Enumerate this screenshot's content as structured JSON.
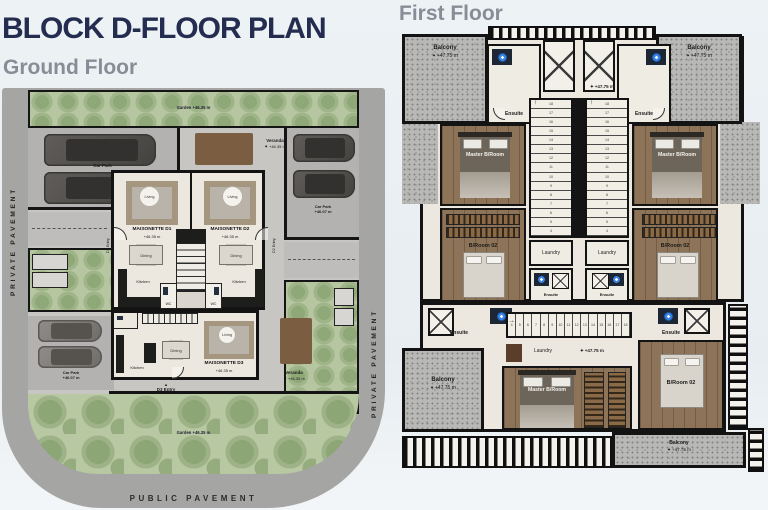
{
  "header": {
    "title": "BLOCK D-FLOOR PLAN",
    "ground_floor_label": "Ground Floor",
    "first_floor_label": "First Floor"
  },
  "icons": {
    "compass": "✦",
    "stair_arrow": "↑",
    "entry_marker": "▲"
  },
  "colors": {
    "title_navy": "#242d4f",
    "subtitle_gray": "#878d96",
    "pavement_gray": "#a5a5a3",
    "courtyard_gray": "#c8c6c3",
    "garden_green": "#b6c6a0",
    "wall_black": "#141414",
    "floor_beige": "#ece8df",
    "wood_brown": "#8d7358",
    "fixture_blue": "#3b87e8"
  },
  "ground_floor": {
    "pavement": {
      "private_label": "PRIVATE PAVEMENT",
      "public_label": "PUBLIC PAVEMENT"
    },
    "garden": {
      "label": "Garden",
      "level": "+46.35 m"
    },
    "car_park": {
      "label": "Car Park",
      "level": "+46.07 m"
    },
    "veranda": {
      "label": "Veranda",
      "level": "+46.35 m"
    },
    "rooms": {
      "living": "Living",
      "dining": "Dining",
      "kitchen": "Kitchen",
      "wc": "WC"
    },
    "units": [
      {
        "name": "MAISONETTE D1",
        "level": "+46.35 m",
        "entry": "D1 Entry"
      },
      {
        "name": "MAISONETTE D2",
        "level": "+46.35 m",
        "entry": "D2 Entry"
      },
      {
        "name": "MAISONETTE D3",
        "level": "+46.35 m",
        "entry": "D3 Entry"
      }
    ]
  },
  "first_floor": {
    "balcony": {
      "label": "Balcony",
      "level": "+47.75 m"
    },
    "level_label": "+47.75 m",
    "rooms": {
      "ensuite": "Ensuite",
      "master_bedroom": "Master B/Room",
      "bedroom2": "B/Room 02",
      "laundry": "Laundry"
    },
    "stairs": {
      "down_numbers": [
        "18",
        "17",
        "16",
        "15",
        "14",
        "13",
        "12",
        "11",
        "10",
        "9",
        "8",
        "7",
        "6",
        "5",
        "4"
      ],
      "up_numbers": [
        "4",
        "5",
        "6",
        "7",
        "8",
        "9",
        "10",
        "11",
        "12",
        "13",
        "14",
        "15",
        "16",
        "17",
        "18"
      ]
    }
  }
}
